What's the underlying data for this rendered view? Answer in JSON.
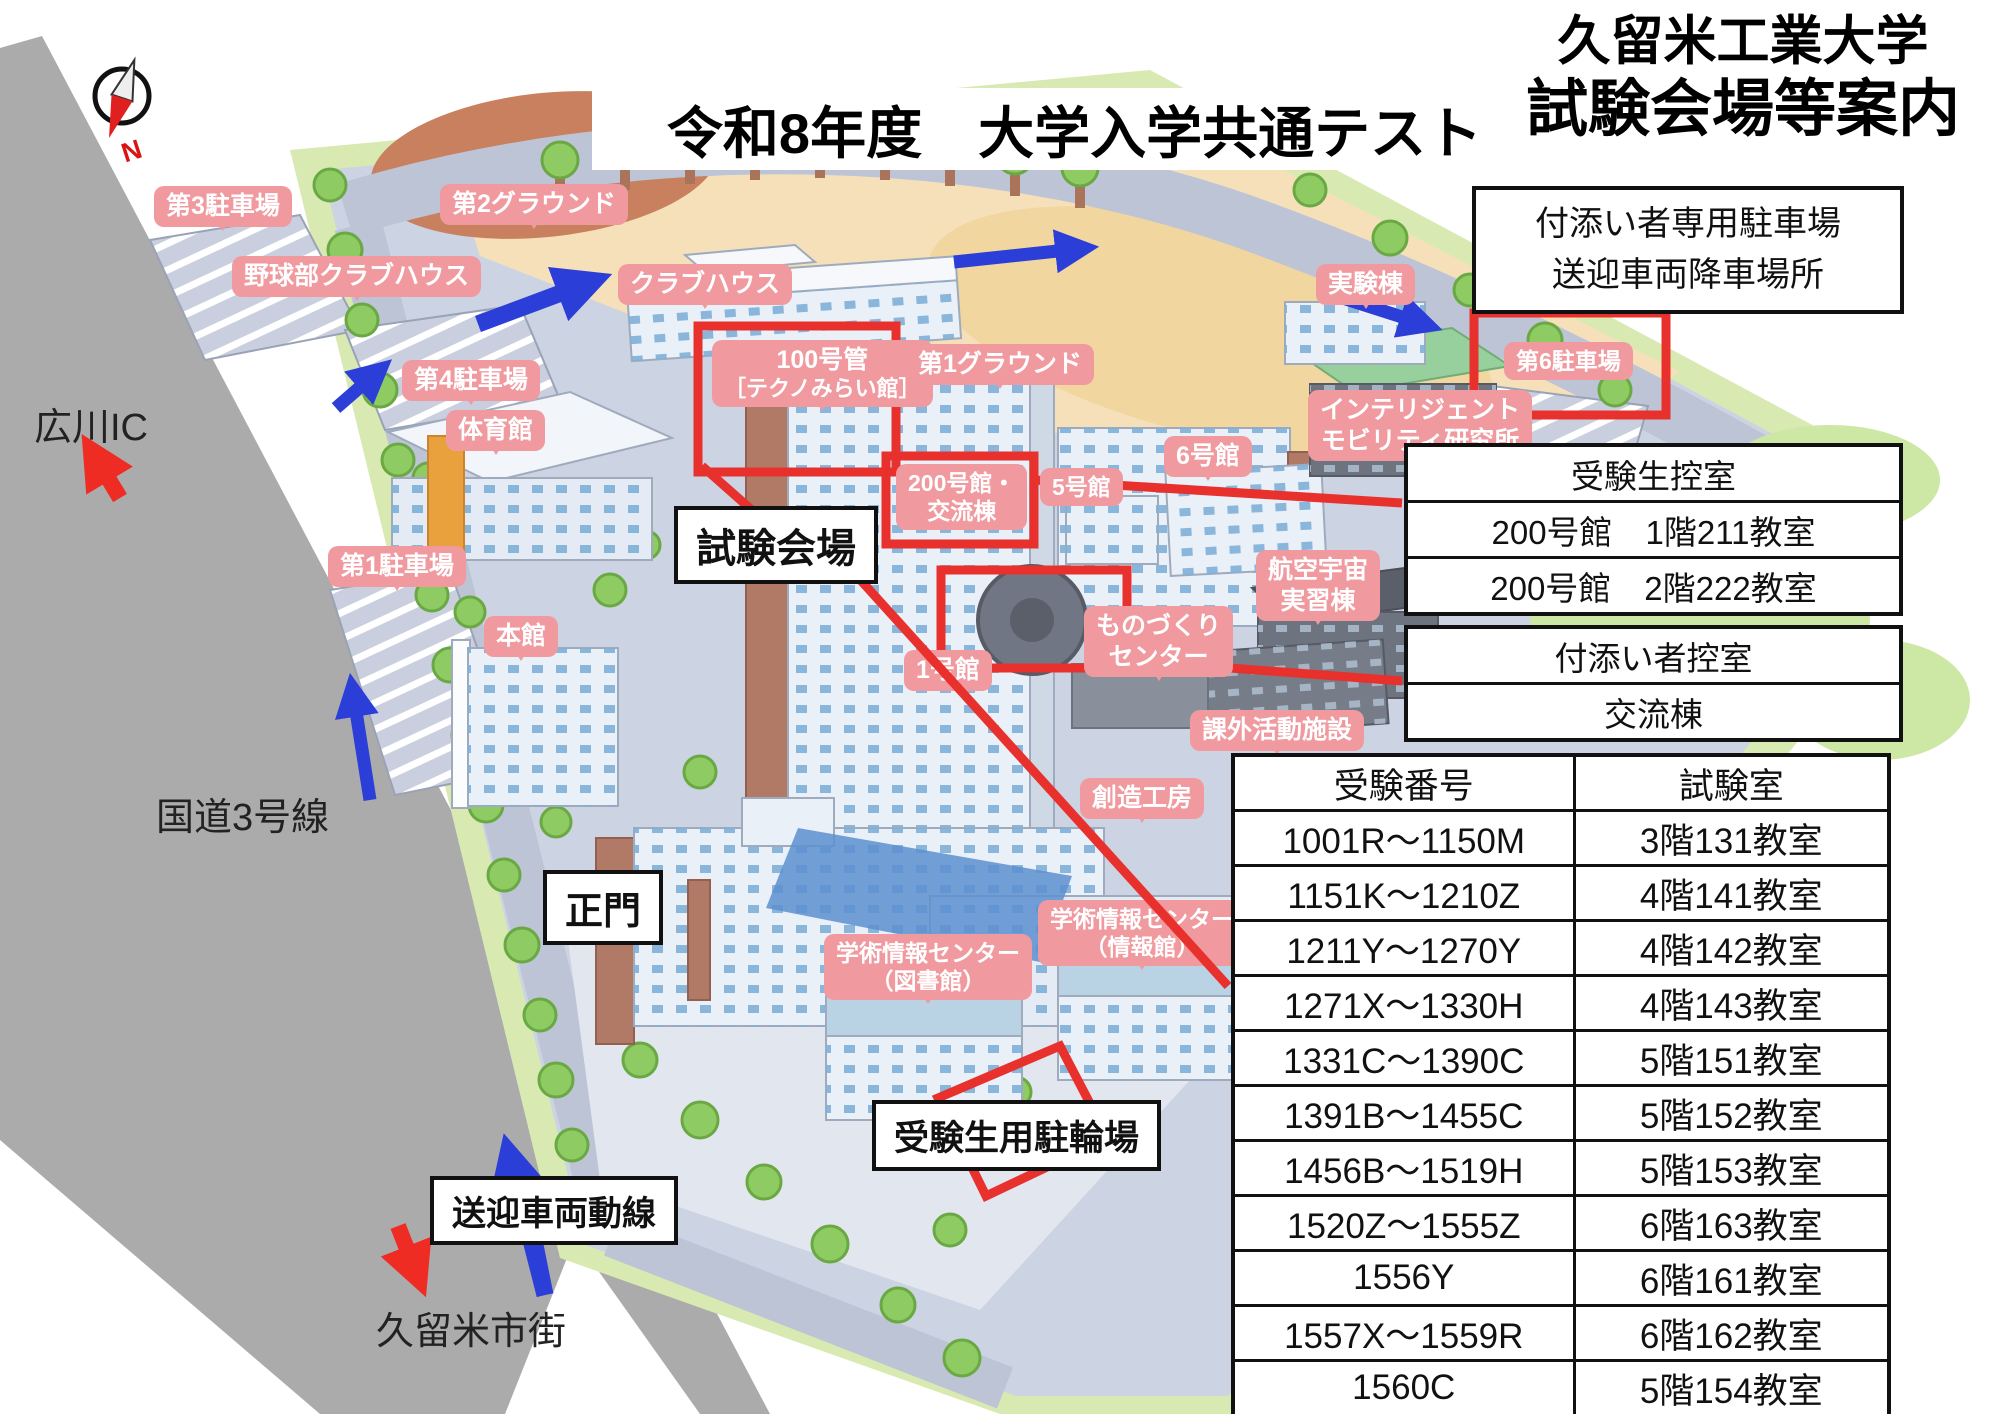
{
  "title": {
    "main": "令和8年度　大学入学共通テスト",
    "school": "久留米工業大学",
    "subtitle": "試験会場等案内"
  },
  "info_boxes": {
    "companion_parking": {
      "line1": "付添い者専用駐車場",
      "line2": "送迎車両降車場所"
    },
    "examinee_waiting": {
      "header": "受験生控室",
      "row1": "200号館　1階211教室",
      "row2": "200号館　2階222教室"
    },
    "companion_waiting": {
      "header": "付添い者控室",
      "row1": "交流棟"
    }
  },
  "room_table": {
    "headers": [
      "受験番号",
      "試験室"
    ],
    "rows": [
      [
        "1001R～1150M",
        "3階131教室"
      ],
      [
        "1151K～1210Z",
        "4階141教室"
      ],
      [
        "1211Y～1270Y",
        "4階142教室"
      ],
      [
        "1271X～1330H",
        "4階143教室"
      ],
      [
        "1331C～1390C",
        "5階151教室"
      ],
      [
        "1391B～1455C",
        "5階152教室"
      ],
      [
        "1456B～1519H",
        "5階153教室"
      ],
      [
        "1520Z～1555Z",
        "6階163教室"
      ],
      [
        "1556Y",
        "6階161教室"
      ],
      [
        "1557X～1559R",
        "6階162教室"
      ],
      [
        "1560C",
        "5階154教室"
      ]
    ]
  },
  "map": {
    "bubbles": [
      {
        "line1": "第3駐車場"
      },
      {
        "line1": "野球部クラブハウス"
      },
      {
        "line1": "第2グラウンド"
      },
      {
        "line1": "第4駐車場"
      },
      {
        "line1": "クラブハウス"
      },
      {
        "line1": "体育館"
      },
      {
        "line1": "100号管",
        "line2": "［テクノみらい館］"
      },
      {
        "line1": "第1グラウンド"
      },
      {
        "line1": "実験棟"
      },
      {
        "line1": "第6駐車場"
      },
      {
        "line1": "インテリジェント",
        "line2": "モビリティ研究所"
      },
      {
        "line1": "6号館"
      },
      {
        "line1": "200号館・",
        "line2": "交流棟"
      },
      {
        "line1": "5号館"
      },
      {
        "line1": "航空宇宙",
        "line2": "実習棟"
      },
      {
        "line1": "ものづくり",
        "line2": "センター"
      },
      {
        "line1": "第1駐車場"
      },
      {
        "line1": "本館"
      },
      {
        "line1": "1号館"
      },
      {
        "line1": "課外活動施設"
      },
      {
        "line1": "創造工房"
      },
      {
        "line1": "学術情報センター",
        "line2": "（図書館）"
      },
      {
        "line1": "学術情報センター",
        "line2": "（情報館）"
      }
    ],
    "callouts": [
      {
        "label": "試験会場"
      },
      {
        "label": "正門"
      },
      {
        "label": "送迎車両動線"
      },
      {
        "label": "受験生用駐輪場"
      }
    ],
    "road_labels": [
      {
        "text": "広川IC"
      },
      {
        "text": "国道3号線"
      },
      {
        "text": "久留米市街"
      }
    ],
    "compass_n": "N"
  },
  "colors": {
    "bubble_pink": "#f09aa0",
    "highlight_red": "#e8312d",
    "arrow_blue": "#2b3fd8",
    "arrow_red": "#ee2c24",
    "road_gray": "#ababab",
    "campus_ground": "#ccd3e2"
  }
}
